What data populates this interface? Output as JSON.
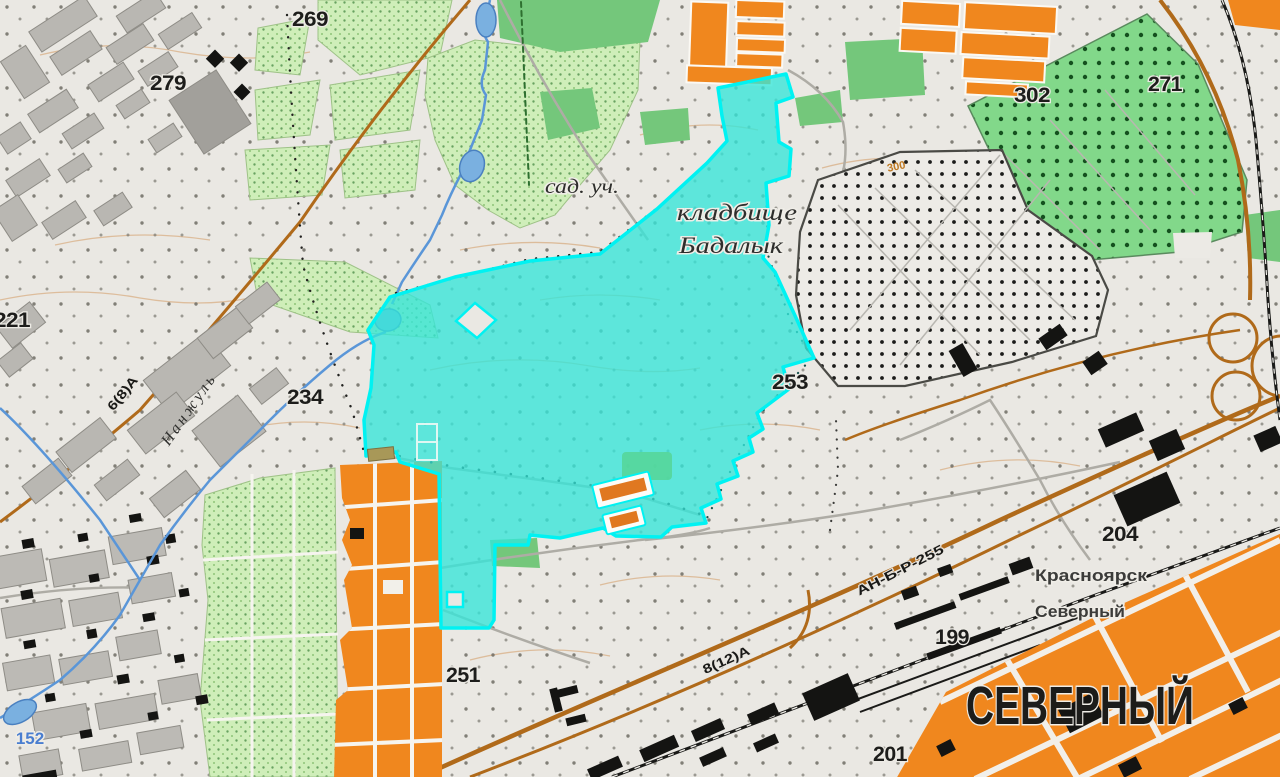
{
  "map_labels": {
    "district": "СЕВЕРНЫЙ",
    "station_line1": "Красноярск",
    "station_line2": "Северный",
    "garden_area": "сад. уч.",
    "cemetery_line1": "кладбище",
    "cemetery_line2": "Бадалык",
    "river": "Нанжуль",
    "contour": "300",
    "water_level": "152"
  },
  "elevations": [
    "269",
    "279",
    "221",
    "234",
    "253",
    "302",
    "271",
    "204",
    "199",
    "201",
    "251"
  ],
  "road_labels": [
    "6(8)А",
    "8(12)А",
    "АН-Б-Р-255"
  ],
  "colors": {
    "background": "#EAE8E3",
    "highlight_fill": "#35E6D9",
    "highlight_border": "#00F2F2",
    "orange_block": "#F0871E",
    "garden_green": "#CFEEB9",
    "forest_green": "#74C77B",
    "reserve_green": "#82D88A",
    "road_brown": "#B06A1A",
    "water_blue": "#5A96D8",
    "building_gray": "#B9B7B2",
    "building_black": "#141412"
  }
}
